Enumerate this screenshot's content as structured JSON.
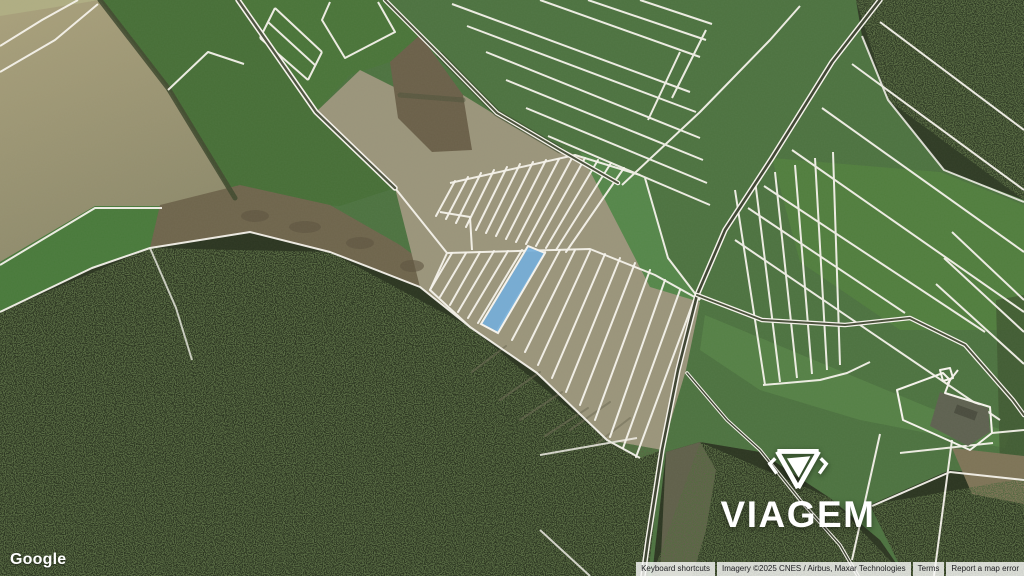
{
  "provider": {
    "logo_text": "Google"
  },
  "watermark": {
    "brand": "VIAGEM",
    "icon": "gem-icon"
  },
  "map_attribution": {
    "keyboard_shortcuts": "Keyboard shortcuts",
    "imagery_credit": "Imagery ©2025 CNES / Airbus, Maxar Technologies",
    "terms": "Terms",
    "report_error": "Report a map error"
  },
  "colors": {
    "highlight_parcel_fill": "#72aedd",
    "highlight_parcel_stroke": "#f8f5ee",
    "parcel_boundary": "#f8f5ee"
  }
}
